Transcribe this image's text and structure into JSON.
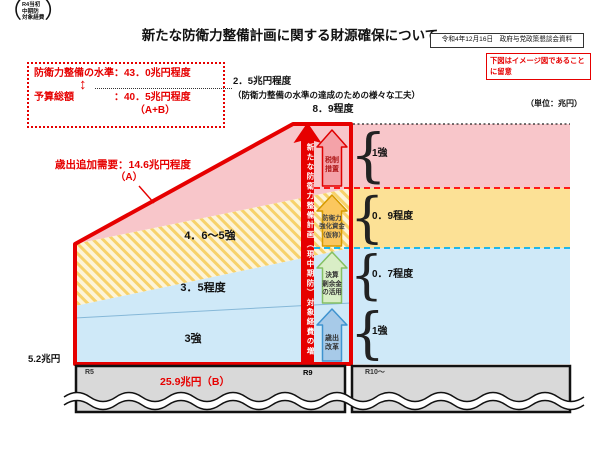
{
  "page": {
    "title": "新たな防衛力整備計画に関する財源確保について",
    "source_note": "令和4年12月16日　政府与党政策懇談会資料",
    "notice": "下図はイメージ図であることに留意",
    "unit_label": "（単位：兆円）"
  },
  "summary_box": {
    "line1": "防衛力整備の水準：43．0兆円程度",
    "line2": "予算総額　　　　：40．5兆円程度",
    "line3": "（A+B）",
    "updown_glyph": "↕"
  },
  "gap_annotation": {
    "value": "2．5兆円程度",
    "note": "（防衛力整備の水準の達成のための様々な工夫）"
  },
  "demand_annotation": {
    "label": "歳出追加需要：14.6兆円程度",
    "sub": "（A）"
  },
  "chart": {
    "total_label": "8．9程度",
    "main_arrow_text": "新たな防衛力整備計画（現中期防）対象経費の増",
    "brace_glyph": "{",
    "areas": [
      {
        "label": "4．6～5強"
      },
      {
        "label": "3．5程度"
      },
      {
        "label": "3強"
      }
    ],
    "funding_arrows": [
      {
        "label": "税制\n措置"
      },
      {
        "label": "防衛力\n強化資金\n（仮称）"
      },
      {
        "label": "決算\n剰余金\nの活用"
      },
      {
        "label": "歳出\n改革"
      }
    ],
    "bands": [
      {
        "label": "1強"
      },
      {
        "label": "0．9程度"
      },
      {
        "label": "0．7程度"
      },
      {
        "label": "1強"
      }
    ]
  },
  "baseline": {
    "left_value": "5.2兆円",
    "paren_open": "（",
    "paren_close": "）",
    "left_note_lines": [
      "R4当初",
      "中期防",
      "対象経費"
    ],
    "r5": "R5",
    "r9": "R9",
    "r10": "R10～",
    "total_b": "25.9兆円（B）"
  },
  "colors": {
    "accent_red": "#e60000",
    "pink_band": "#f8c6ca",
    "yellow_band": "#fce196",
    "blue_band": "#cfe9f8",
    "hatch_base": "#fdf4d8",
    "hatch_stripe": "#f7d26b",
    "gray_block": "#d9d9d9",
    "cyan_dash": "#00b0f0",
    "arrow_tax_fill": "#f4a2a8",
    "arrow_fund_fill": "#fbc75e",
    "arrow_surplus_fill": "#d9eec6",
    "arrow_reform_fill": "#a7cae8"
  }
}
